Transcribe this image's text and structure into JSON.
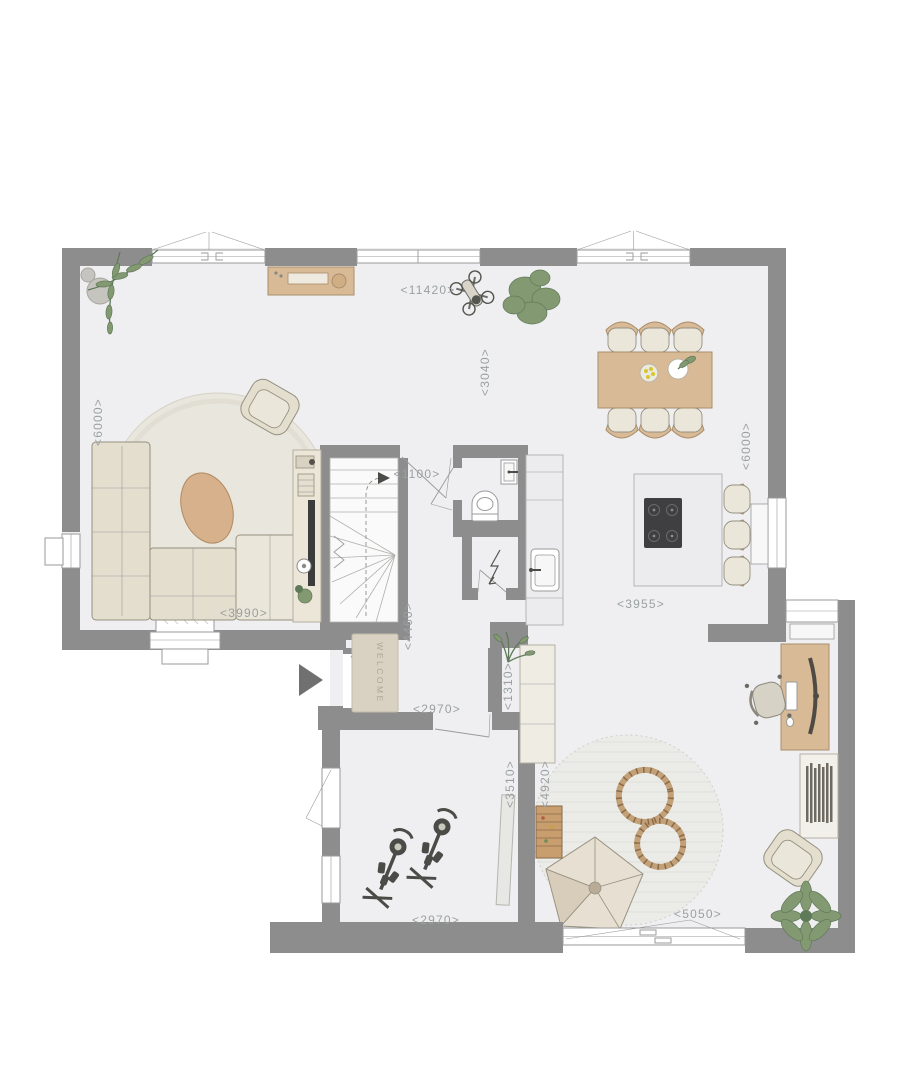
{
  "colors": {
    "wall": "#8d8d8d",
    "floor": "#efeff1",
    "line": "#9a9a9a",
    "label": "#9aa0a0",
    "beige": "#e4decf",
    "cushion": "#ebe6da",
    "wood": "#d9ba96",
    "wood_dark": "#a98d6b",
    "counter": "#ececee",
    "cooktop": "#3f3f41",
    "plant": "#839972",
    "plant_dark": "#5f7a58",
    "rug": "#e9e6dd",
    "mat": "#d9d1c2",
    "mat_text": "#b2a693",
    "track": "#c2a078",
    "arrow": "#707070"
  },
  "dims": {
    "top": "<11420>",
    "dining": "<3040>",
    "left": "<6000>",
    "right": "<6000>",
    "stair_door": "<1100>",
    "living": "<3990>",
    "corridor": "<4460>",
    "island": "<3955>",
    "hall": "<2970>",
    "entry": "<1310>",
    "gym": "<2970>",
    "gym_depth": "<3510>",
    "play": "<4920>",
    "patio": "<5050>"
  },
  "mat_label": "WELCOME"
}
